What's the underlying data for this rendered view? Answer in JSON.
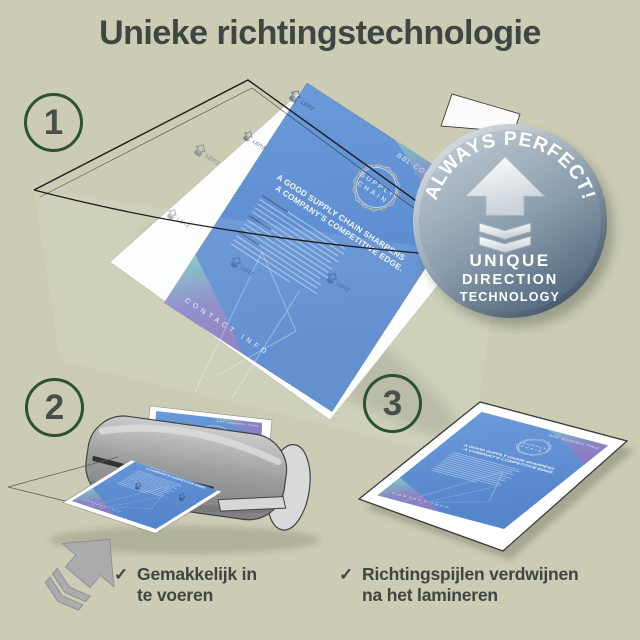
{
  "title": "Unieke richtingstechnologie",
  "steps": [
    "1",
    "2",
    "3"
  ],
  "badge": {
    "arc_text": "ALWAYS PERFECT!",
    "line1": "UNIQUE",
    "line2": "DIRECTION",
    "line3": "TECHNOLOGY"
  },
  "document": {
    "brand": "BBL CONSULTING",
    "logo_line1": "SUPPLY",
    "logo_line2": "CHAIN",
    "headline_line1": "A GOOD SUPPLY CHAIN SHARPENS",
    "headline_line2": "A COMPANY'S COMPETITIVE EDGE.",
    "footer": "CONTACT INFO",
    "watermark": "LEITZ"
  },
  "checklist": {
    "check_glyph": "✓",
    "item1_line1": "Gemakkelijk in",
    "item1_line2": "te voeren",
    "item2_line1": "Richtingspijlen verdwijnen",
    "item2_line2": "na het lamineren"
  },
  "colors": {
    "background": "#cbccb3",
    "heading_text": "#3e4643",
    "step_circle_green": "#2b5331",
    "document_blue": "#5b8fd0",
    "corner_gradient_teal": "#7ec7c5",
    "corner_gradient_purple": "#9079c0",
    "badge_light": "#c2ccd4",
    "badge_dark": "#51667c",
    "machine_gray": "#9b9d9f",
    "arrow_gray": "#a9abac"
  }
}
